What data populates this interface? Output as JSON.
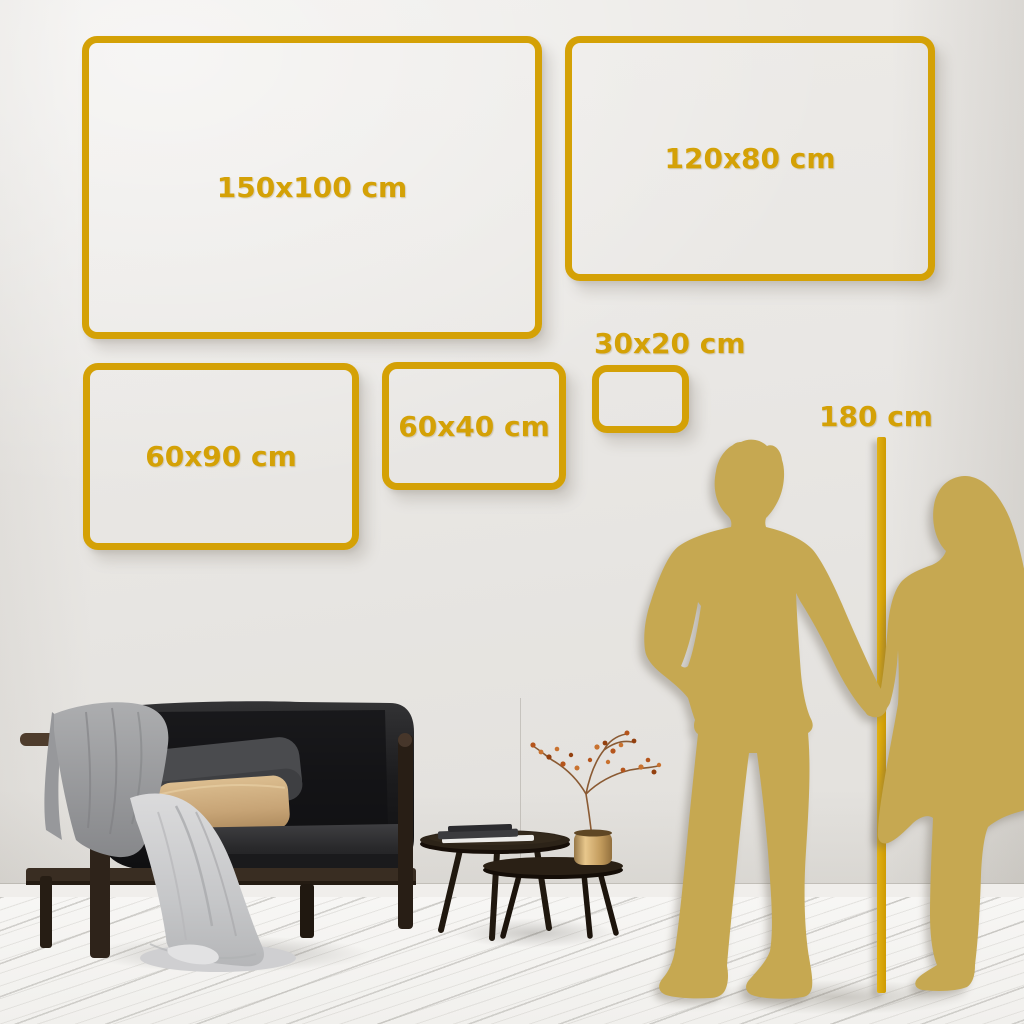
{
  "colors": {
    "gold": "#D4A106",
    "figure": "#C6A851",
    "wall": "#E9E7E4",
    "floor": "#F4F3F1"
  },
  "size_frames": [
    {
      "label": "150x100 cm",
      "x": 82,
      "y": 36,
      "w": 460,
      "h": 303,
      "label_pos": "center"
    },
    {
      "label": "120x80 cm",
      "x": 565,
      "y": 36,
      "w": 370,
      "h": 245,
      "label_pos": "center"
    },
    {
      "label": "60x90 cm",
      "x": 83,
      "y": 363,
      "w": 276,
      "h": 187,
      "label_pos": "center"
    },
    {
      "label": "60x40 cm",
      "x": 382,
      "y": 362,
      "w": 184,
      "h": 128,
      "label_pos": "center"
    },
    {
      "label": "30x20 cm",
      "x": 592,
      "y": 365,
      "w": 97,
      "h": 68,
      "label_pos": "above"
    }
  ],
  "height_marker": {
    "label": "180 cm",
    "line_x": 877,
    "line_width": 9,
    "line_top": 437,
    "line_bottom": 993,
    "label_x": 876,
    "label_y": 400
  },
  "scene": {
    "figures": [
      {
        "name": "man-silhouette"
      },
      {
        "name": "woman-silhouette"
      }
    ],
    "furniture": [
      {
        "name": "sofa"
      },
      {
        "name": "throw-blanket"
      },
      {
        "name": "front-drape"
      },
      {
        "name": "cushion-dark"
      },
      {
        "name": "cushion-beige"
      },
      {
        "name": "coffee-table-large"
      },
      {
        "name": "coffee-table-small"
      },
      {
        "name": "books-stack"
      },
      {
        "name": "brass-vase"
      },
      {
        "name": "decor-branch"
      }
    ]
  }
}
